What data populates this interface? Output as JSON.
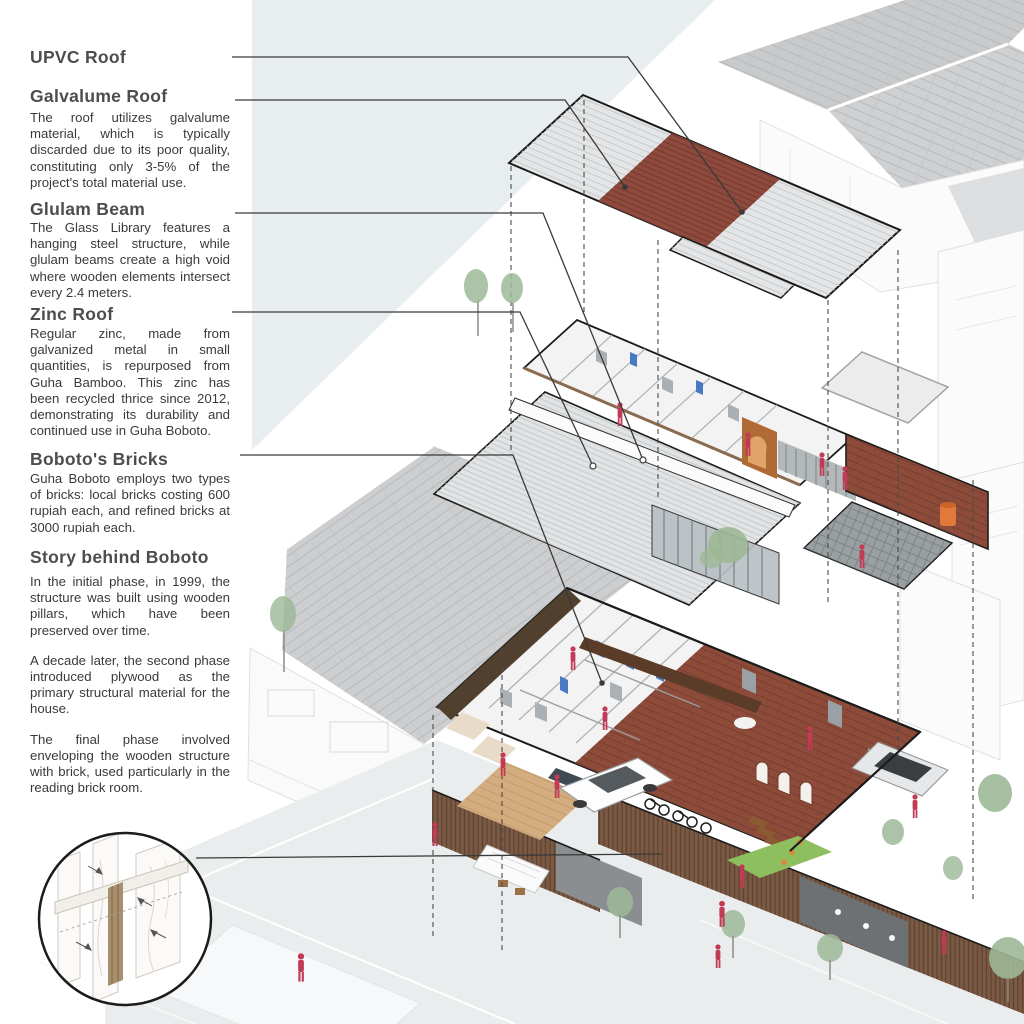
{
  "page": {
    "background": "#ffffff",
    "type": "architectural exploded axonometric poster"
  },
  "annotations": [
    {
      "title": "UPVC Roof",
      "body": ""
    },
    {
      "title": "Galvalume Roof",
      "body": "The roof utilizes galvalume material, which is typically discarded due to its poor quality, constituting only 3-5% of the project's total material use."
    },
    {
      "title": "Glulam Beam",
      "body": "The Glass Library features a hanging steel structure, while glulam beams create a high void where wooden elements intersect every 2.4 meters."
    },
    {
      "title": "Zinc Roof",
      "body": "Regular zinc, made from galvanized metal in small quantities, is repurposed from Guha Bamboo. This zinc has been recycled thrice since 2012, demonstrating its durability and continued use in Guha Boboto."
    },
    {
      "title": "Boboto's Bricks",
      "body": "Guha Boboto employs two types of bricks: local bricks costing 600 rupiah each, and refined bricks at 3000 rupiah each."
    },
    {
      "title": "Story behind Boboto",
      "paragraphs": [
        "In the initial phase, in 1999, the structure was built using wooden pillars, which have been preserved over time.",
        "A decade later, the second phase introduced plywood as the primary structural material for the house.",
        "The final phase involved enveloping the wooden structure with brick, used particularly in the reading brick room."
      ]
    }
  ],
  "colors": {
    "heading": "#4d4d4d",
    "body_text": "#3a3a3a",
    "leader_line": "#3a3a3a",
    "outline": "#1b1b1b",
    "roof_gray": "#e4e5e6",
    "galvalume_red": "#8e4a3d",
    "zinc": "#e1e3e4",
    "brick": "#8d4b3a",
    "dark_wood_wall": "#52402f",
    "carved_wood": "#5a3c28",
    "wood_floor": "#d3ad80",
    "fence_wood": "#7b5a43",
    "glass": "#b9c1c4",
    "platform_gray": "#9aa0a2",
    "street": "#e9edee",
    "grass": "#8ebf5e",
    "tree_green": "#9cb896",
    "figure_pink": "#c23a55",
    "door_blue": "#4779c4",
    "tank_orange": "#e2793c",
    "context_roof": "#c9cacb",
    "pale_wedge": "#e8edef",
    "white_rooms": "#f3f3f3"
  }
}
